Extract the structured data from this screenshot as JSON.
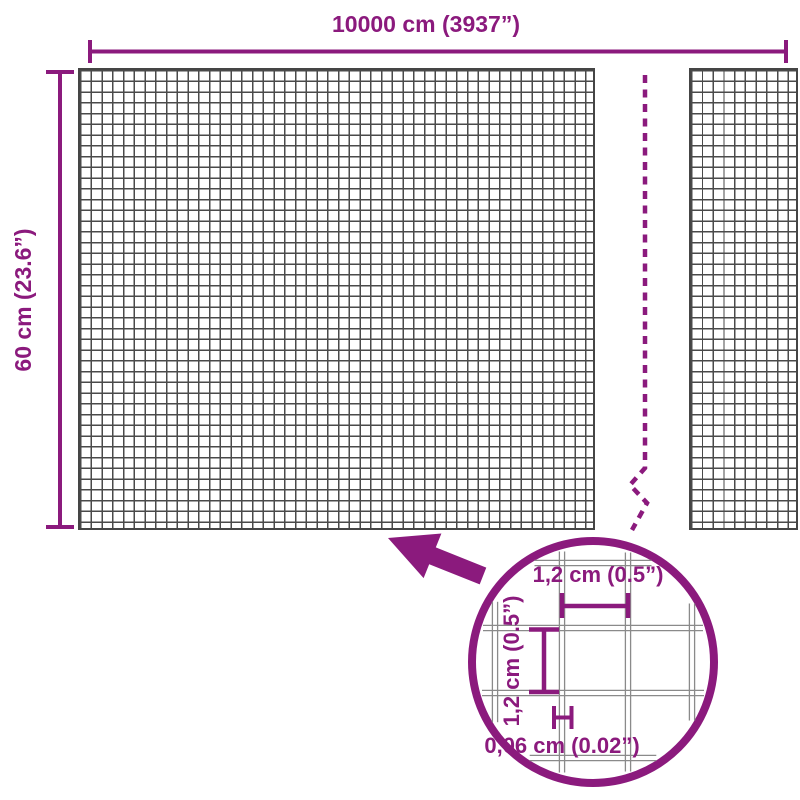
{
  "colors": {
    "accent": "#8b1a7d",
    "mesh_line": "#4a4a4a",
    "zoom_wire": "#8a8a8a",
    "background": "#ffffff"
  },
  "dimensions": {
    "width_label": "10000 cm (3937”)",
    "height_label": "60 cm (23.6”)"
  },
  "magnifier": {
    "cell_width_label": "1,2 cm (0.5”)",
    "cell_height_label": "1,2 cm (0.5”)",
    "wire_thickness_label": "0,06 cm (0.02”)"
  }
}
